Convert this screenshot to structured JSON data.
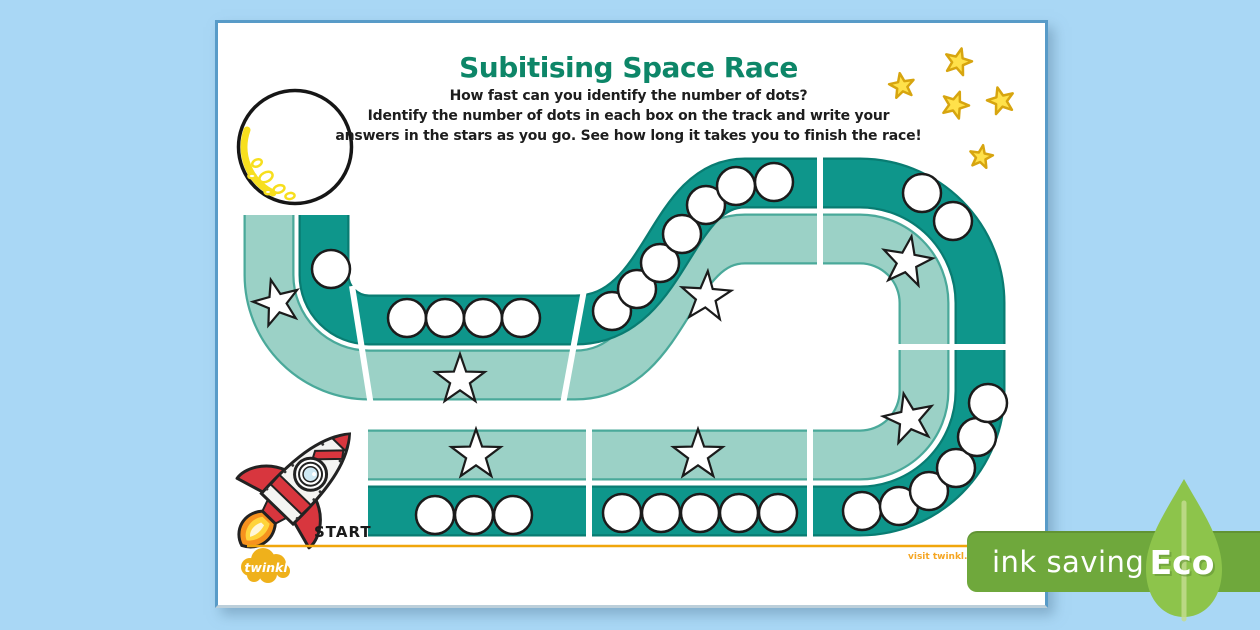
{
  "colors": {
    "background": "#a9d7f5",
    "paper": "#ffffff",
    "page_border": "#589bc8",
    "title_green": "#0d8668",
    "text_dark": "#1d1d1d",
    "track_dark": "#0e968b",
    "track_dark_edge": "#097c72",
    "track_light": "#9bd1c6",
    "track_light_edge": "#4aa99a",
    "star_yellow_fill": "#ffe14a",
    "star_yellow_stroke": "#d7a50f",
    "moon_yellow": "#f7df1e",
    "rocket_red": "#d8363e",
    "flame_orange": "#f6921e",
    "flame_yellow": "#ffd43b",
    "rule_orange": "#f0a60c",
    "twinkl_yellow": "#efb11b",
    "visit_orange": "#f5a623",
    "badge_green": "#6fa83c",
    "leaf_green": "#8dc44b"
  },
  "header": {
    "title": "Subitising Space Race",
    "subtitle": "How fast can you identify the number of dots?",
    "instructions_line1": "Identify the number of dots in each box on the track and write your",
    "instructions_line2": "answers in the stars as you go. See how long it takes you to finish the race!"
  },
  "track": {
    "start_label": "START",
    "segments": [
      {
        "id": "bottom-left-straight",
        "dot_count": 3,
        "dots": [
          [
            435,
            515
          ],
          [
            474,
            515
          ],
          [
            513,
            515
          ]
        ],
        "star": [
          476,
          455
        ],
        "star_rot": 0
      },
      {
        "id": "bottom-right-straight",
        "dot_count": 5,
        "dots": [
          [
            622,
            513
          ],
          [
            661,
            513
          ],
          [
            700,
            513
          ],
          [
            739,
            513
          ],
          [
            778,
            513
          ]
        ],
        "star": [
          698,
          455
        ],
        "star_rot": 0
      },
      {
        "id": "right-bottom-curve",
        "dot_count": 6,
        "dots": [
          [
            862,
            511
          ],
          [
            899,
            506
          ],
          [
            929,
            491
          ],
          [
            956,
            468
          ],
          [
            977,
            437
          ],
          [
            988,
            403
          ]
        ],
        "star": [
          909,
          419
        ],
        "star_rot": -12
      },
      {
        "id": "right-top-curve",
        "dot_count": 2,
        "dots": [
          [
            922,
            193
          ],
          [
            953,
            221
          ]
        ],
        "star": [
          907,
          262
        ],
        "star_rot": 10
      },
      {
        "id": "middle-descent",
        "dot_count": 7,
        "dots": [
          [
            612,
            311
          ],
          [
            637,
            289
          ],
          [
            660,
            263
          ],
          [
            682,
            234
          ],
          [
            706,
            205
          ],
          [
            736,
            186
          ],
          [
            774,
            182
          ]
        ],
        "star": [
          706,
          297
        ],
        "star_rot": 4
      },
      {
        "id": "middle-left-straight",
        "dot_count": 4,
        "dots": [
          [
            407,
            318
          ],
          [
            445,
            318
          ],
          [
            483,
            318
          ],
          [
            521,
            318
          ]
        ],
        "star": [
          460,
          380
        ],
        "star_rot": 0
      },
      {
        "id": "finish-curve",
        "dot_count": 1,
        "dots": [
          [
            331,
            269
          ]
        ],
        "star": [
          277,
          303
        ],
        "star_rot": -15
      }
    ]
  },
  "decor": {
    "yellow_stars": [
      [
        958,
        62,
        15,
        14
      ],
      [
        902,
        86,
        -10,
        13
      ],
      [
        955,
        105,
        20,
        14
      ],
      [
        1001,
        101,
        -15,
        14
      ],
      [
        981,
        157,
        10,
        12
      ]
    ]
  },
  "footer": {
    "brand": "twinkl",
    "visit_text": "visit twinkl."
  },
  "eco": {
    "label": "ink saving",
    "eco_label": "Eco"
  }
}
